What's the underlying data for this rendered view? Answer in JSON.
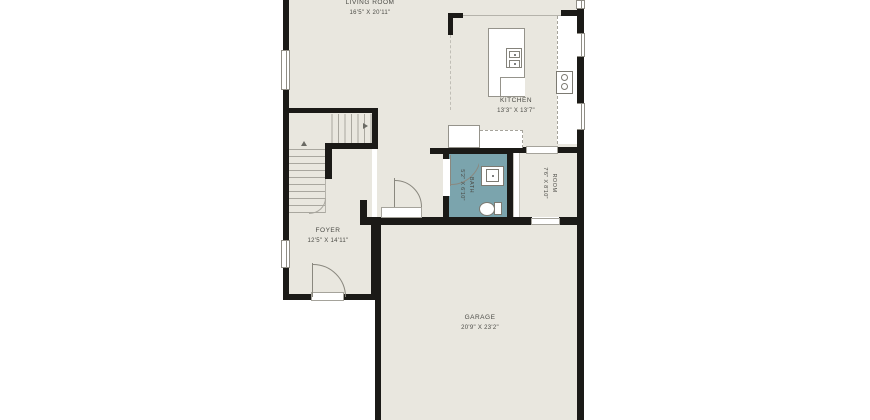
{
  "plan_type": "floor-plan",
  "rooms": {
    "living_room": {
      "name": "LIVING ROOM",
      "dims": "16'5\" X 20'11\""
    },
    "kitchen": {
      "name": "KITCHEN",
      "dims": "13'3\" X 13'7\""
    },
    "foyer": {
      "name": "FOYER",
      "dims": "12'5\" X 14'11\""
    },
    "garage": {
      "name": "GARAGE",
      "dims": "20'9\" X 23'2\""
    },
    "bath": {
      "name": "BATH",
      "dims": "5'2\" X 6'10\""
    },
    "room": {
      "name": "ROOM",
      "dims": "7'6\" X 8'10\""
    }
  },
  "colors": {
    "background": "#ffffff",
    "floor": "#e9e7df",
    "bath_floor": "#7ba4ad",
    "wall": "#1b1a17",
    "label_text": "#4b4b46",
    "fixture_line": "#95938b"
  },
  "fixtures": [
    "kitchen-island",
    "island-sink",
    "range-stove",
    "counter",
    "base-cabinets",
    "bath-vanity",
    "toilet",
    "stairs",
    "front-door",
    "garage-door",
    "bath-door",
    "windows"
  ]
}
